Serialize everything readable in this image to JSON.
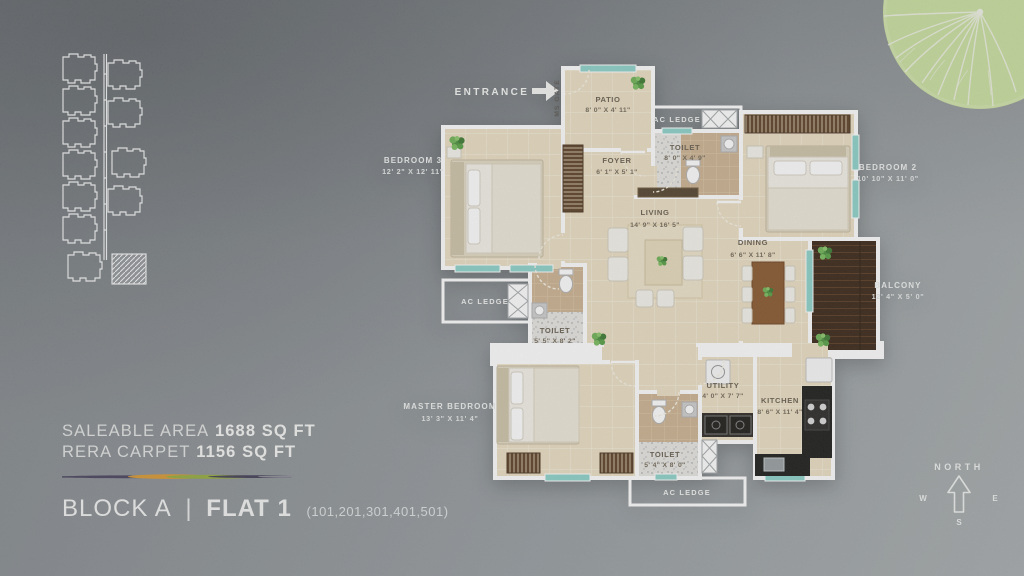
{
  "entrance": {
    "label": "ENTRANCE"
  },
  "plan": {
    "gate_label": "MS GATE",
    "rooms": {
      "patio": {
        "name": "PATIO",
        "dim": "8' 0\" X 4' 11\""
      },
      "foyer": {
        "name": "FOYER",
        "dim": "6' 1\" X 5' 1\""
      },
      "toilet_top": {
        "name": "TOILET",
        "dim": "8' 0\" X 4' 9\""
      },
      "bedroom2": {
        "name": "BEDROOM 2",
        "dim": "10' 10\" X 11' 0\""
      },
      "bedroom3": {
        "name": "BEDROOM 3",
        "dim": "12' 2\" X 12' 11\""
      },
      "living": {
        "name": "LIVING",
        "dim": "14' 9\" X 16' 5\""
      },
      "dining": {
        "name": "DINING",
        "dim": "6' 6\" X 11' 8\""
      },
      "balcony": {
        "name": "BALCONY",
        "dim": "12' 4\" X 5' 0\""
      },
      "toilet_mid": {
        "name": "TOILET",
        "dim": "5' 5\" X 8' 2\""
      },
      "master_bedroom": {
        "name": "MASTER BEDROOM",
        "dim": "13' 3\" X 11' 4\""
      },
      "toilet_bottom": {
        "name": "TOILET",
        "dim": "5' 4\" X 8' 0\""
      },
      "utility": {
        "name": "UTILITY",
        "dim": "4' 0\" X 7' 7\""
      },
      "kitchen": {
        "name": "KITCHEN",
        "dim": "8' 6\" X 11' 4\""
      }
    },
    "ledges": {
      "top": "AC LEDGE",
      "left": "AC LEDGE",
      "bottom": "AC LEDGE"
    }
  },
  "summary": {
    "saleable_label": "SALEABLE AREA",
    "saleable_value": "1688 SQ FT",
    "rera_label": "RERA CARPET",
    "rera_value": "1156 SQ FT"
  },
  "title": {
    "block": "BLOCK A",
    "separator": "|",
    "flat": "FLAT 1",
    "units": "(101,201,301,401,501)"
  },
  "compass": {
    "north": "NORTH",
    "west": "W",
    "east": "E",
    "south": "S"
  },
  "colors": {
    "floor_cream": "#ecdfc4",
    "balcony_wood": "#3b2718",
    "window_teal": "#8fd2cb",
    "leaf_green": "#cbe0a0"
  }
}
